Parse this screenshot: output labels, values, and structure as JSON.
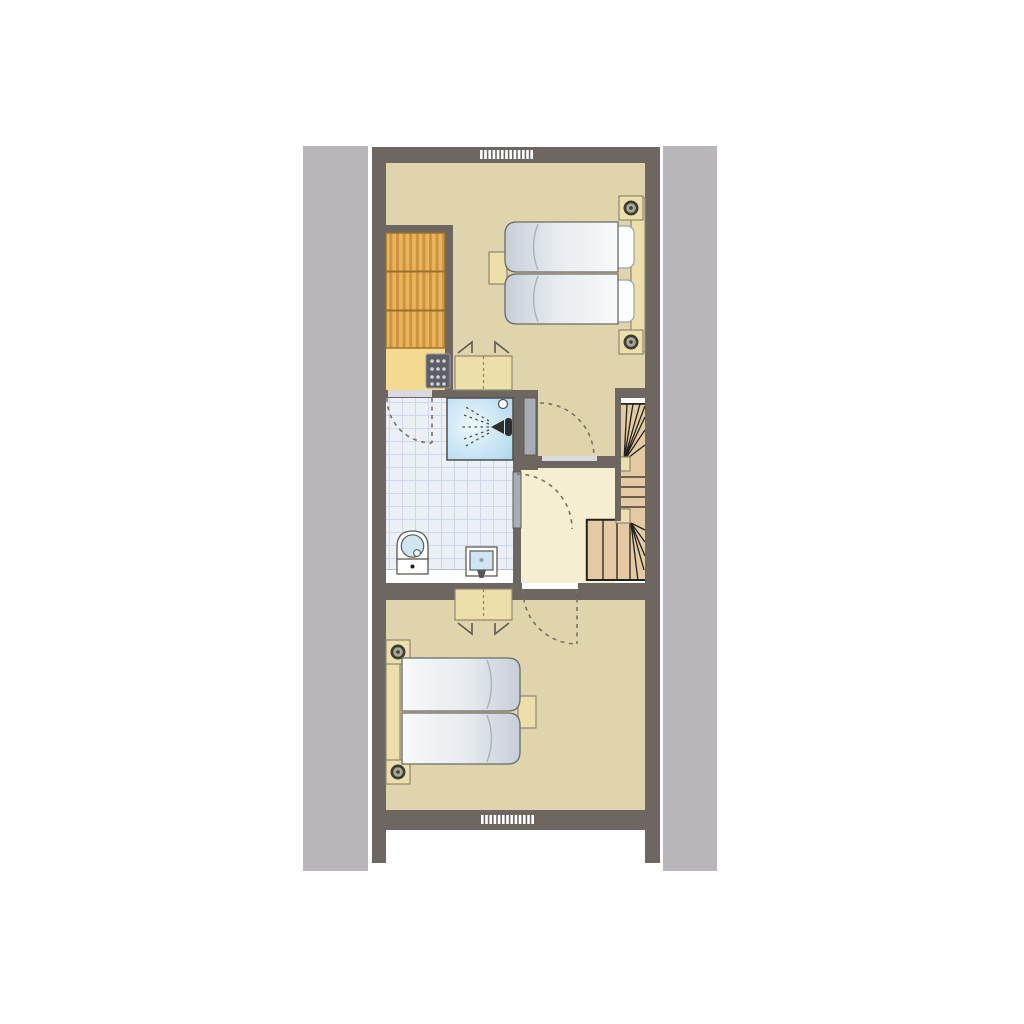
{
  "title": "Holiday home upper floor plan",
  "plan_type": "architectural-floor-plan",
  "palette": {
    "white": "#ffffff",
    "facade_band": "#b9b6bb",
    "wall": "#6e6661",
    "bedroom_floor": "#e0d4ac",
    "landing_floor": "#f6eed1",
    "closet_floor": "#f4da90",
    "bathroom_floor": "#ebf0f6",
    "tile_line": "#ccd8e8",
    "wardrobe": "#eab45c",
    "wardrobe_stripe": "#cd9340",
    "wardrobe_border": "#9c6f28",
    "stairs_wood": "#e4caa2",
    "stair_line": "#222220",
    "furniture_wood": "#eddfa9",
    "furniture_border": "#8c8672",
    "outline": "#5c5a52",
    "door_leaf": "#a6adb7",
    "threshold": "#d9d9df",
    "swing_arc": "#7a7060",
    "mattress_light": "#f7f9fa",
    "mattress_shade": "#c5ced8",
    "pillow": "#fcfdfe",
    "fixture_blue": "#cfe5f3",
    "heater_body": "#5e5e66",
    "heater_dots": "#cfd2d8",
    "shower_edge": "#a5d2ec",
    "shower_center": "#eef8fd"
  },
  "rooms": [
    {
      "id": "bedroom-top",
      "name": "bedroom with double bed"
    },
    {
      "id": "wardrobe-closet",
      "name": "built-in wardrobe / heater closet"
    },
    {
      "id": "bathroom",
      "name": "bathroom with shower, toilet and washbasin"
    },
    {
      "id": "landing",
      "name": "stair landing"
    },
    {
      "id": "staircase",
      "name": "winder staircase"
    },
    {
      "id": "bedroom-bottom",
      "name": "bedroom with double bed"
    }
  ],
  "furniture": [
    "double-bed",
    "mattress",
    "pillow",
    "bedpost",
    "headboard",
    "nightstand",
    "wardrobe",
    "dresser",
    "heater-unit",
    "shower",
    "shower-head",
    "toilet",
    "washbasin",
    "stair-newel-post",
    "door-leaf",
    "door-swing-arc",
    "window-vent"
  ],
  "vents": {
    "top_dash_count": 13,
    "bottom_dash_count": 13
  }
}
